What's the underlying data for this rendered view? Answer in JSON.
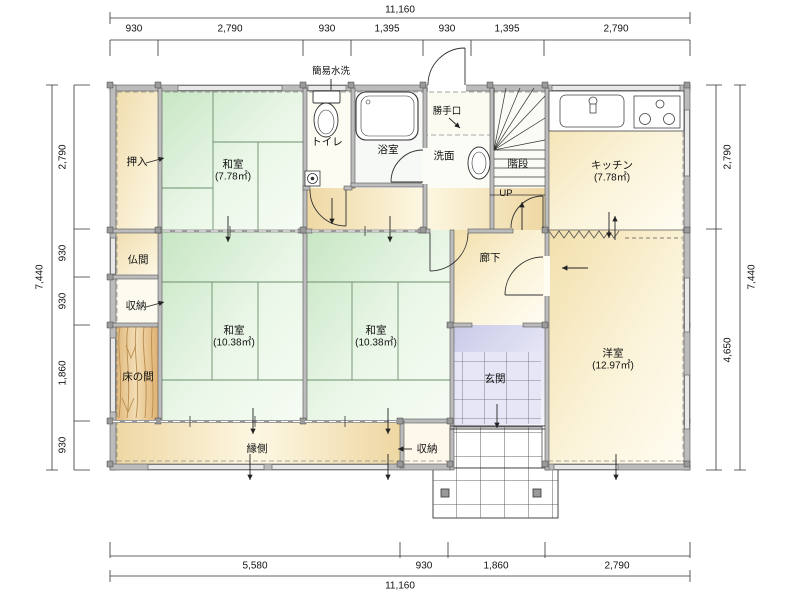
{
  "drawing": {
    "type": "floor-plan",
    "labels": {
      "toilet_note": "簡易水洗",
      "oshiire": "押入",
      "washitsu1": "和室",
      "washitsu1_area": "(7.78㎡)",
      "toilet": "トイレ",
      "bath": "浴室",
      "katteguchi": "勝手口",
      "senmen": "洗面",
      "kaidan": "階段",
      "up": "UP",
      "kitchen": "キッチン",
      "kitchen_area": "(7.78㎡)",
      "butsuma": "仏間",
      "shuno_left": "収納",
      "tokonoma": "床の間",
      "washitsu2": "和室",
      "washitsu2_area": "(10.38㎡)",
      "washitsu3": "和室",
      "washitsu3_area": "(10.38㎡)",
      "roka": "廊下",
      "genkan": "玄関",
      "yoshitsu": "洋室",
      "yoshitsu_area": "(12.97㎡)",
      "engawa": "縁側",
      "shuno_bottom": "収納"
    },
    "dimensions": {
      "top": {
        "total": "11,160",
        "segments": [
          "930",
          "2,790",
          "930",
          "1,395",
          "930",
          "1,395",
          "2,790"
        ]
      },
      "bottom": {
        "total": "11,160",
        "segments": [
          "5,580",
          "930",
          "1,860",
          "2,790"
        ]
      },
      "left": {
        "total": "7,440",
        "segments": [
          "2,790",
          "930",
          "930",
          "1,860",
          "930"
        ]
      },
      "right": {
        "total": "7,440",
        "segments": [
          "2,790",
          "4,650"
        ]
      }
    },
    "colors": {
      "tatami_green": "#cfe9cb",
      "cream": "#f3e0ae",
      "closet_yellow": "#f1dfae",
      "wood": "#e2b878",
      "genkan_tile": "#cfcfec",
      "wall_gray": "#bcbcbc"
    }
  }
}
